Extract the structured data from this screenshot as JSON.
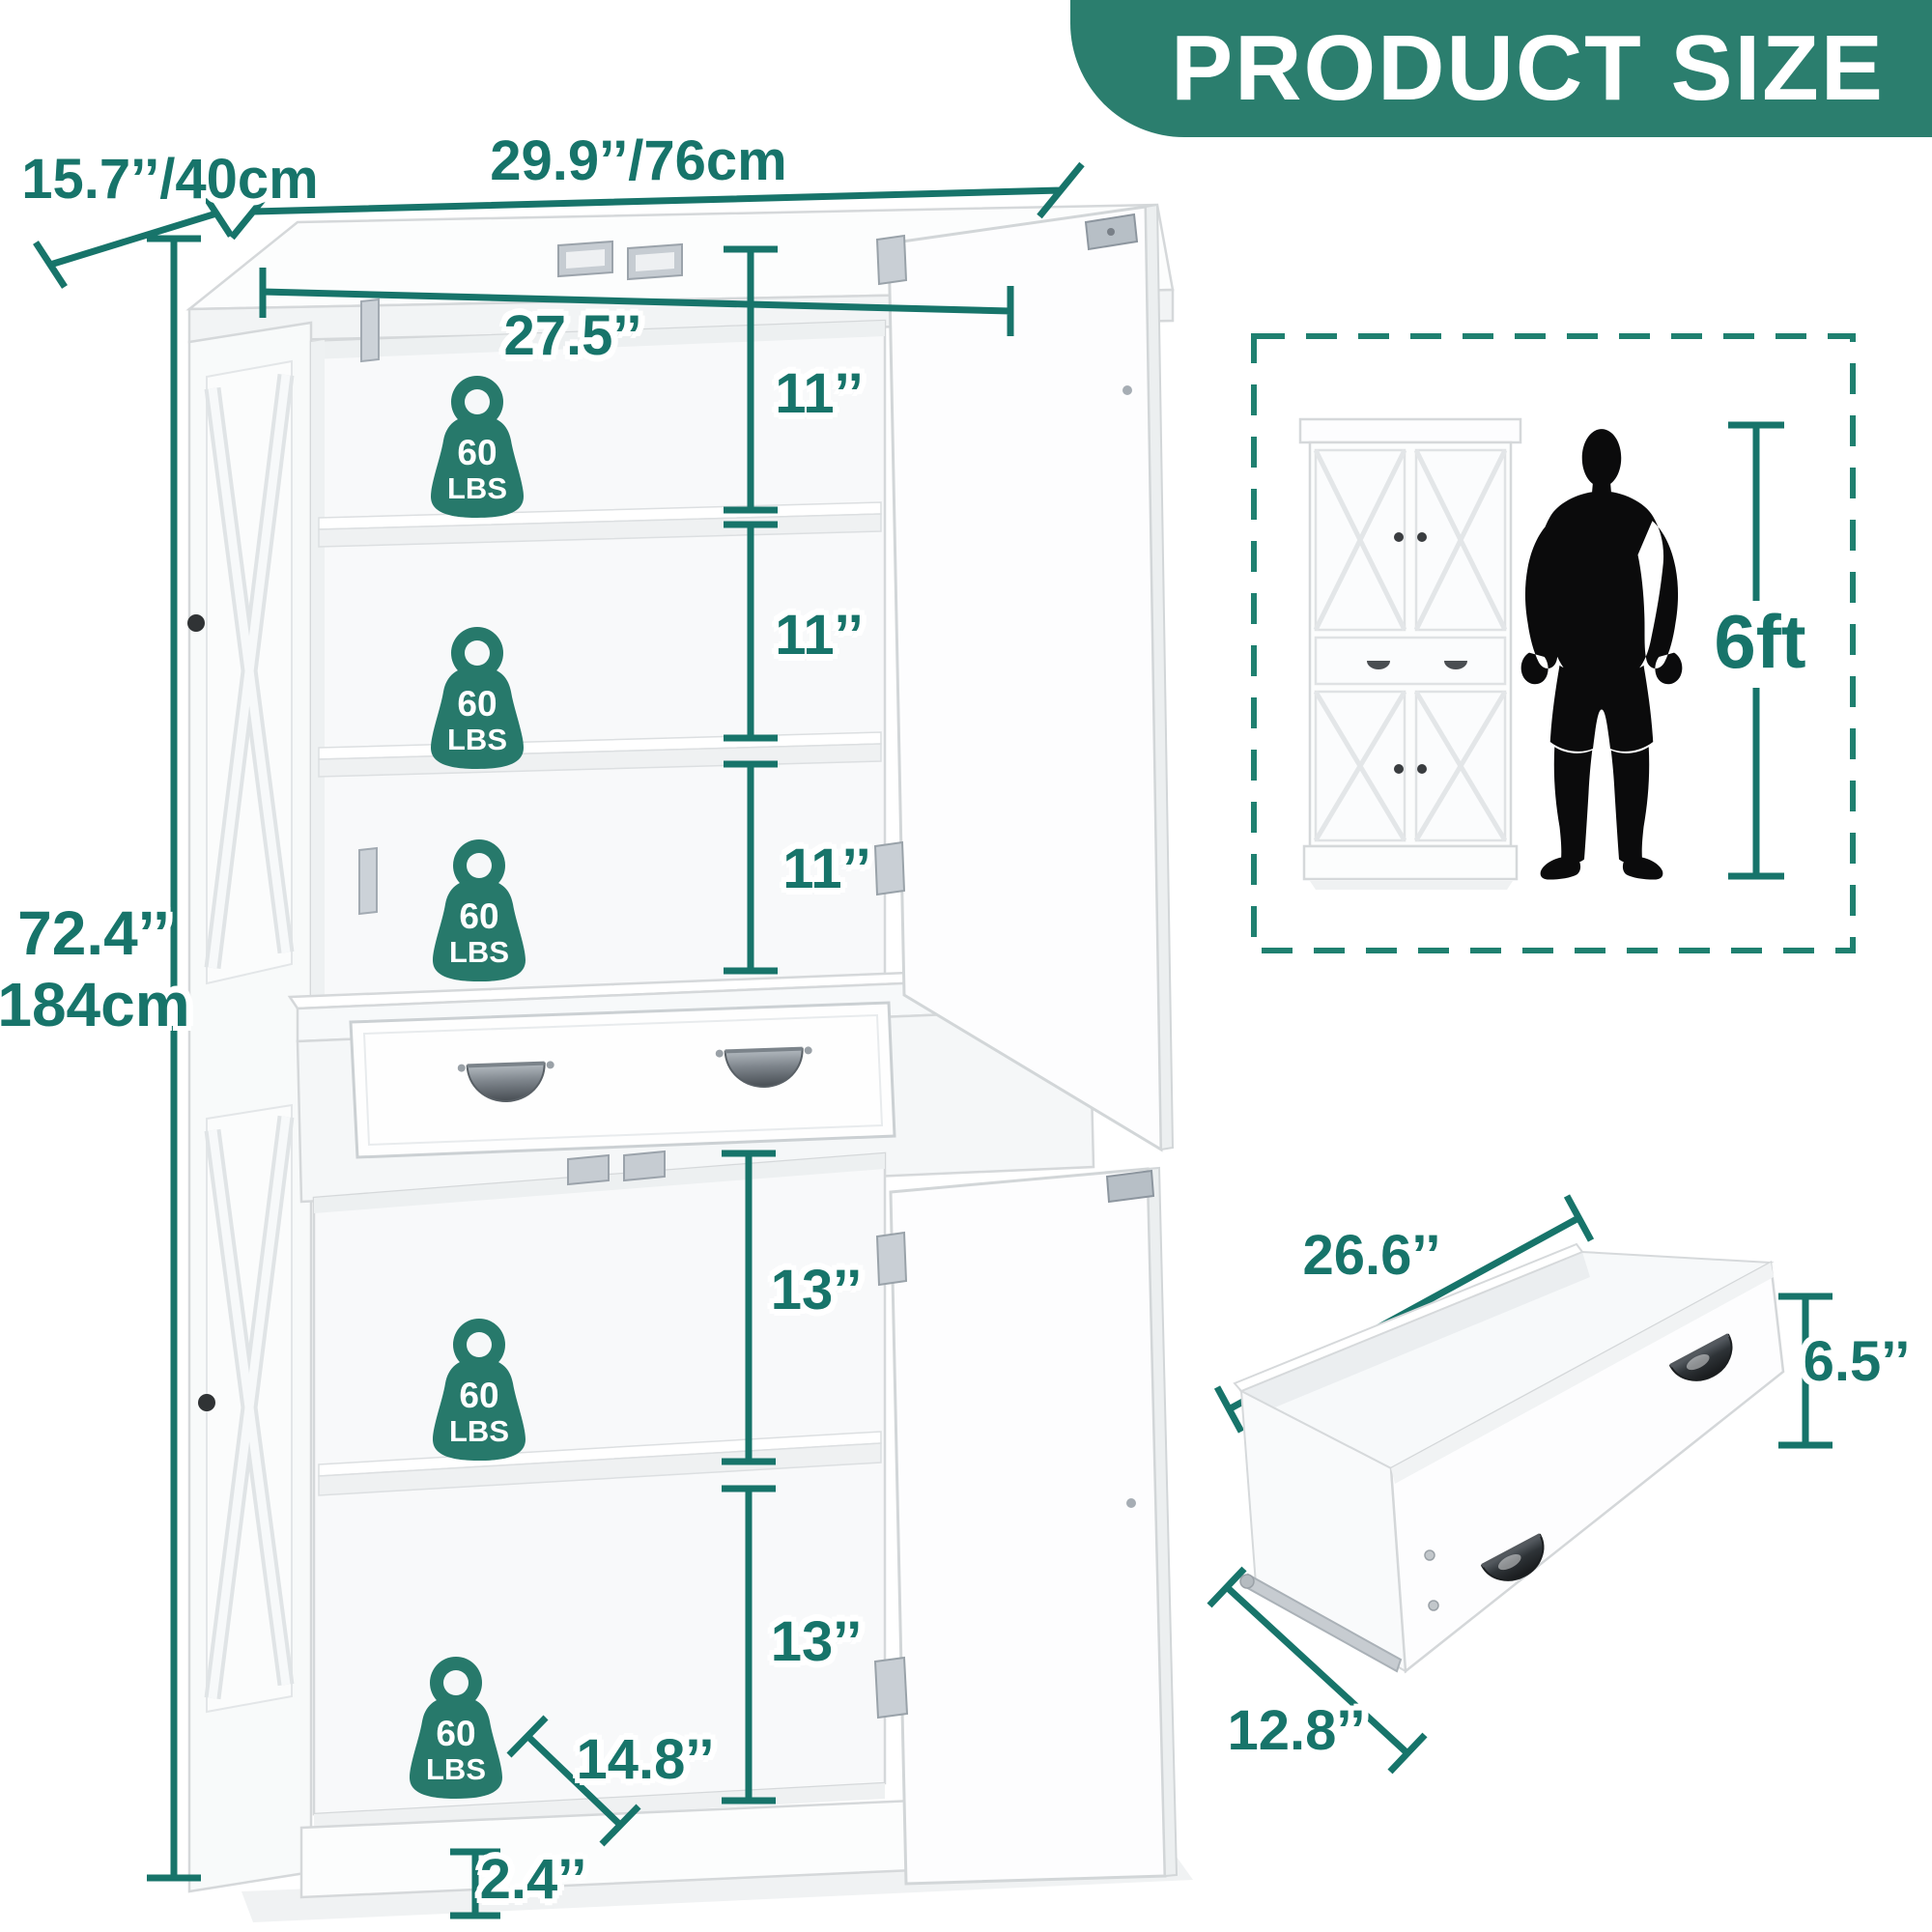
{
  "title": "PRODUCT SIZE",
  "colors": {
    "accent": "#17746a",
    "banner": "#2b7e6e",
    "badge": "#27796b",
    "dash": "#1f8070"
  },
  "cabinet": {
    "depth": "15.7’’/40cm",
    "width": "29.9’’/76cm",
    "height_in": "72.4’’",
    "height_cm": "184cm",
    "inner_width": "27.5’’",
    "upper_sections": [
      "11’’",
      "11’’",
      "11’’"
    ],
    "lower_sections": [
      "13’’",
      "13’’"
    ],
    "bottom_shelf_depth": "14.8’’",
    "base_height": "2.4’’",
    "capacity": {
      "value": "60",
      "unit": "LBS"
    }
  },
  "scale": {
    "person_height": "6ft"
  },
  "drawer": {
    "width": "26.6’’",
    "height": "6.5’’",
    "depth": "12.8’’"
  }
}
